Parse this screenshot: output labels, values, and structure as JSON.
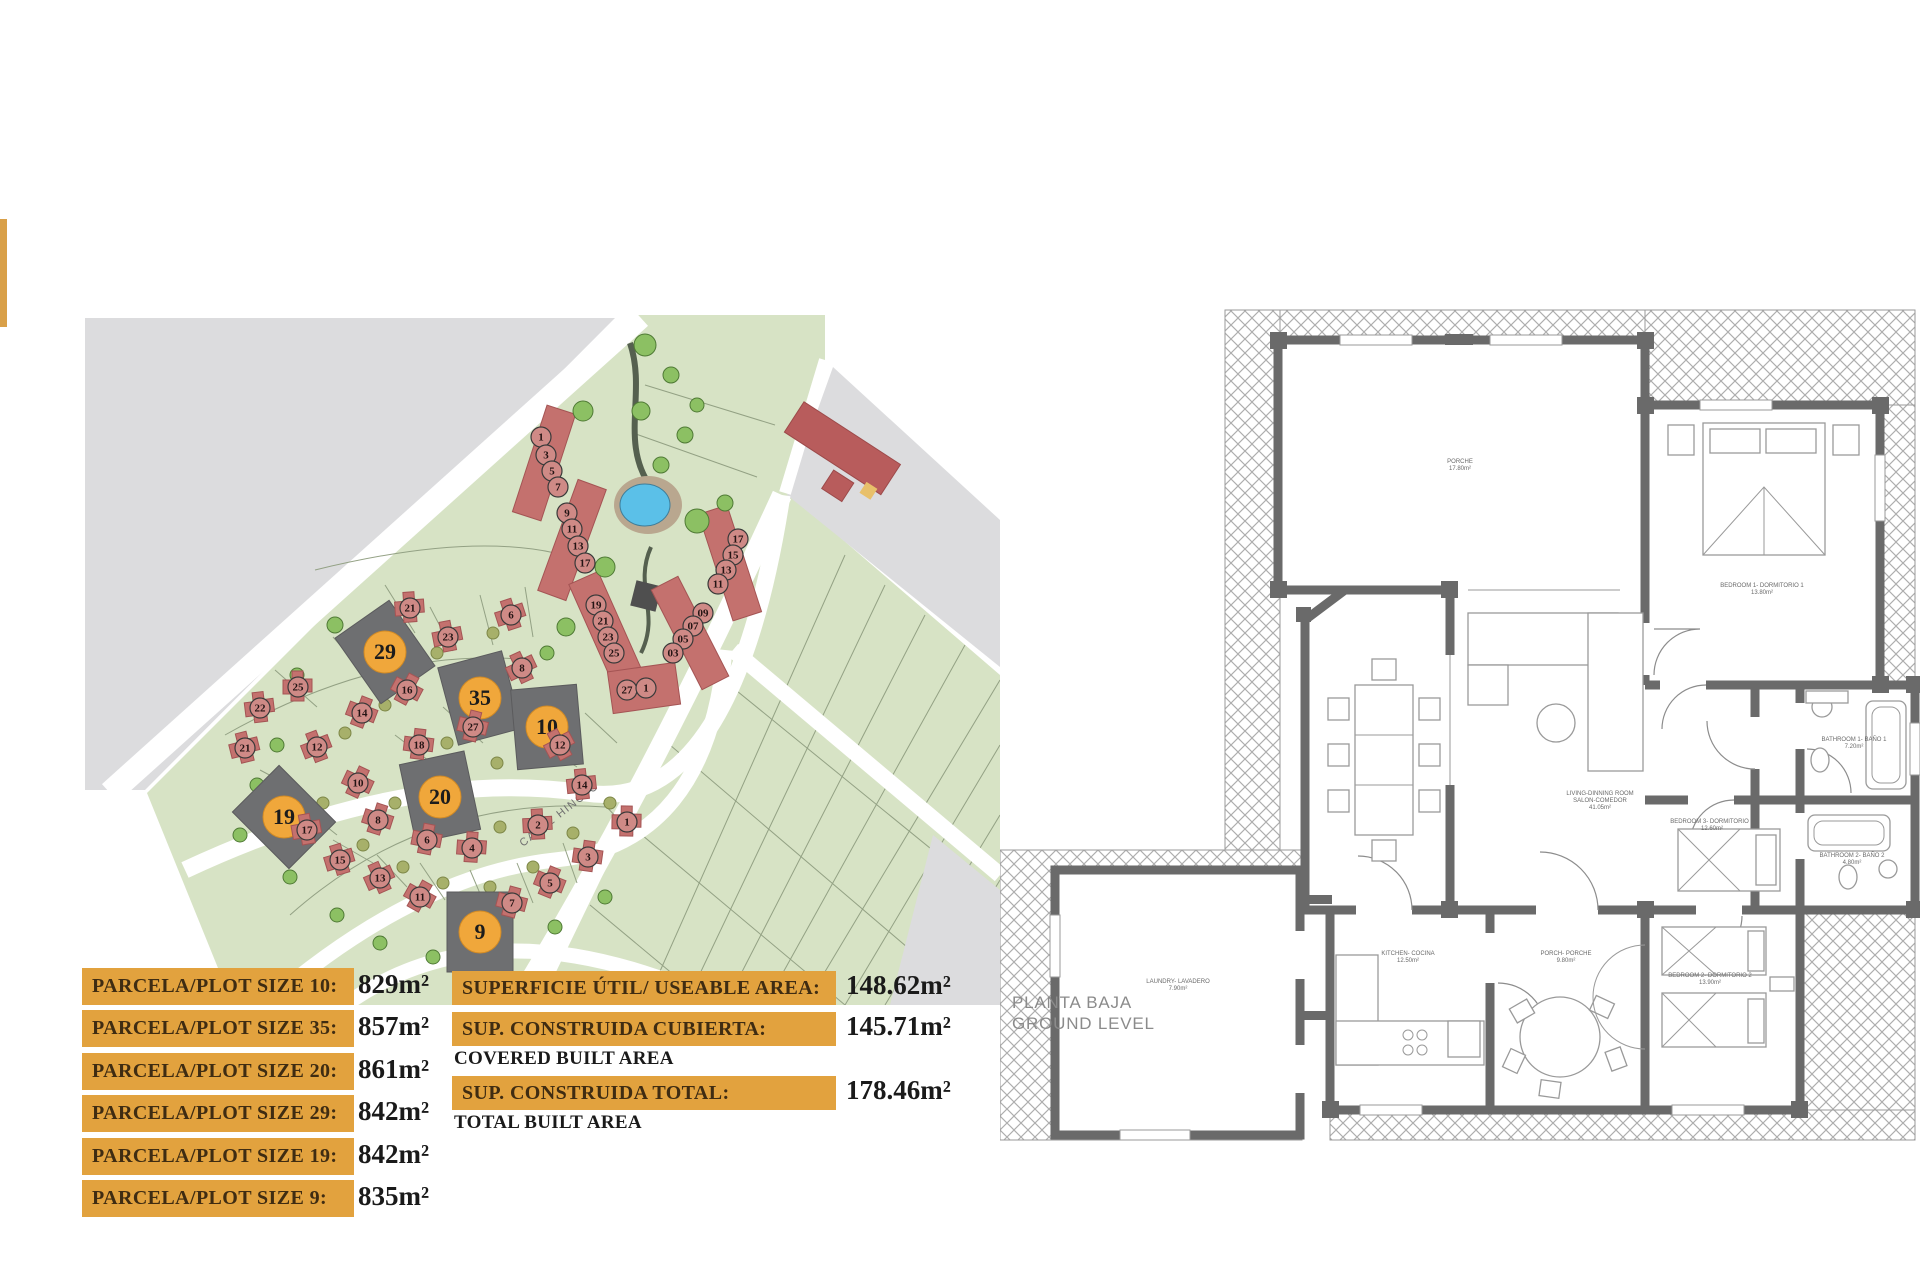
{
  "accent_color": "#D9A049",
  "bar_color": "#E2A23E",
  "plot_sizes": [
    {
      "label": "PARCELA/PLOT SIZE 10:",
      "value": "829m²"
    },
    {
      "label": "PARCELA/PLOT SIZE 35:",
      "value": "857m²"
    },
    {
      "label": "PARCELA/PLOT SIZE 20:",
      "value": "861m²"
    },
    {
      "label": "PARCELA/PLOT SIZE 29:",
      "value": "842m²"
    },
    {
      "label": "PARCELA/PLOT SIZE 19:",
      "value": "842m²"
    },
    {
      "label": "PARCELA/PLOT SIZE 9:",
      "value": "835m²"
    }
  ],
  "area_info": [
    {
      "label": "SUPERFICIE ÚTIL/ USEABLE AREA:",
      "sublabel": "",
      "value": "148.62m²"
    },
    {
      "label": "SUP. CONSTRUIDA CUBIERTA:",
      "sublabel": "COVERED BUILT AREA",
      "value": "145.71m²"
    },
    {
      "label": "SUP. CONSTRUIDA TOTAL:",
      "sublabel": "TOTAL BUILT AREA",
      "value": "178.46m²"
    }
  ],
  "site_plan": {
    "street_label": "CALLE HINOJO",
    "highlighted_plots": [
      {
        "n": "29",
        "x": 300,
        "y": 337,
        "a": -35
      },
      {
        "n": "35",
        "x": 395,
        "y": 383,
        "a": -15
      },
      {
        "n": "10",
        "x": 462,
        "y": 412,
        "a": -5
      },
      {
        "n": "20",
        "x": 355,
        "y": 482,
        "a": -12
      },
      {
        "n": "19",
        "x": 199,
        "y": 502,
        "a": -45
      },
      {
        "n": "9",
        "x": 395,
        "y": 617,
        "a": 0
      }
    ],
    "house_markers": [
      {
        "n": "1",
        "x": 456,
        "y": 122,
        "t": "r"
      },
      {
        "n": "3",
        "x": 461,
        "y": 140,
        "t": "r"
      },
      {
        "n": "5",
        "x": 467,
        "y": 156,
        "t": "r"
      },
      {
        "n": "7",
        "x": 473,
        "y": 172,
        "t": "r"
      },
      {
        "n": "9",
        "x": 482,
        "y": 198,
        "t": "r"
      },
      {
        "n": "11",
        "x": 487,
        "y": 214,
        "t": "r"
      },
      {
        "n": "13",
        "x": 493,
        "y": 231,
        "t": "r"
      },
      {
        "n": "17",
        "x": 500,
        "y": 248,
        "t": "r"
      },
      {
        "n": "17",
        "x": 653,
        "y": 224,
        "t": "r"
      },
      {
        "n": "15",
        "x": 648,
        "y": 240,
        "t": "r"
      },
      {
        "n": "13",
        "x": 641,
        "y": 255,
        "t": "r"
      },
      {
        "n": "11",
        "x": 633,
        "y": 269,
        "t": "r"
      },
      {
        "n": "19",
        "x": 511,
        "y": 290,
        "t": "r"
      },
      {
        "n": "21",
        "x": 518,
        "y": 306,
        "t": "r"
      },
      {
        "n": "23",
        "x": 523,
        "y": 322,
        "t": "r"
      },
      {
        "n": "25",
        "x": 529,
        "y": 338,
        "t": "r"
      },
      {
        "n": "09",
        "x": 618,
        "y": 298,
        "t": "r"
      },
      {
        "n": "07",
        "x": 608,
        "y": 311,
        "t": "r"
      },
      {
        "n": "05",
        "x": 598,
        "y": 324,
        "t": "r"
      },
      {
        "n": "03",
        "x": 588,
        "y": 338,
        "t": "r"
      },
      {
        "n": "27",
        "x": 542,
        "y": 375,
        "t": "r"
      },
      {
        "n": "1",
        "x": 561,
        "y": 373,
        "t": "r"
      },
      {
        "n": "21",
        "x": 325,
        "y": 293,
        "t": "h"
      },
      {
        "n": "23",
        "x": 363,
        "y": 322,
        "t": "h"
      },
      {
        "n": "6",
        "x": 426,
        "y": 300,
        "t": "h"
      },
      {
        "n": "8",
        "x": 437,
        "y": 353,
        "t": "h"
      },
      {
        "n": "16",
        "x": 322,
        "y": 375,
        "t": "h"
      },
      {
        "n": "14",
        "x": 277,
        "y": 398,
        "t": "h"
      },
      {
        "n": "27",
        "x": 388,
        "y": 412,
        "t": "h"
      },
      {
        "n": "18",
        "x": 334,
        "y": 430,
        "t": "h"
      },
      {
        "n": "25",
        "x": 213,
        "y": 372,
        "t": "h"
      },
      {
        "n": "22",
        "x": 175,
        "y": 393,
        "t": "h"
      },
      {
        "n": "21",
        "x": 160,
        "y": 433,
        "t": "h"
      },
      {
        "n": "12",
        "x": 232,
        "y": 432,
        "t": "h"
      },
      {
        "n": "12",
        "x": 475,
        "y": 430,
        "t": "h"
      },
      {
        "n": "10",
        "x": 273,
        "y": 468,
        "t": "h"
      },
      {
        "n": "8",
        "x": 293,
        "y": 505,
        "t": "h"
      },
      {
        "n": "6",
        "x": 342,
        "y": 525,
        "t": "h"
      },
      {
        "n": "4",
        "x": 387,
        "y": 533,
        "t": "h"
      },
      {
        "n": "2",
        "x": 453,
        "y": 510,
        "t": "h"
      },
      {
        "n": "17",
        "x": 222,
        "y": 515,
        "t": "h"
      },
      {
        "n": "15",
        "x": 255,
        "y": 545,
        "t": "h"
      },
      {
        "n": "13",
        "x": 295,
        "y": 563,
        "t": "h"
      },
      {
        "n": "11",
        "x": 335,
        "y": 582,
        "t": "h"
      },
      {
        "n": "5",
        "x": 465,
        "y": 568,
        "t": "h"
      },
      {
        "n": "7",
        "x": 427,
        "y": 588,
        "t": "h"
      },
      {
        "n": "3",
        "x": 503,
        "y": 542,
        "t": "h"
      },
      {
        "n": "1",
        "x": 542,
        "y": 507,
        "t": "h"
      },
      {
        "n": "14",
        "x": 497,
        "y": 470,
        "t": "h"
      }
    ]
  },
  "floor_plan": {
    "title_line1": "PLANTA BAJA",
    "title_line2": "GROUND LEVEL",
    "rooms": [
      {
        "lines": [
          "PORCHE",
          "17.80m²"
        ],
        "x": 460,
        "y": 208
      },
      {
        "lines": [
          "BEDROOM 1- DORMITORIO 1",
          "13.80m²"
        ],
        "x": 762,
        "y": 332
      },
      {
        "lines": [
          "LIVING-DINNING ROOM",
          "SALON-COMEDOR",
          "41.05m²"
        ],
        "x": 600,
        "y": 540
      },
      {
        "lines": [
          "KITCHEN- COCINA",
          "12.50m²"
        ],
        "x": 408,
        "y": 700
      },
      {
        "lines": [
          "LAUNDRY- LAVADERO",
          "7.90m²"
        ],
        "x": 178,
        "y": 728
      },
      {
        "lines": [
          "PORCH- PORCHE",
          "9.80m²"
        ],
        "x": 566,
        "y": 700
      },
      {
        "lines": [
          "BATHROOM 1- BAÑO 1",
          "7.20m²"
        ],
        "x": 854,
        "y": 486
      },
      {
        "lines": [
          "BATHROOM 2- BAÑO 2",
          "4.80m²"
        ],
        "x": 852,
        "y": 602
      },
      {
        "lines": [
          "BEDROOM 3- DORMITORIO 3",
          "12.60m²"
        ],
        "x": 712,
        "y": 568
      },
      {
        "lines": [
          "BEDROOM 2- DORMITORIO 2",
          "13.90m²"
        ],
        "x": 710,
        "y": 722
      }
    ]
  }
}
